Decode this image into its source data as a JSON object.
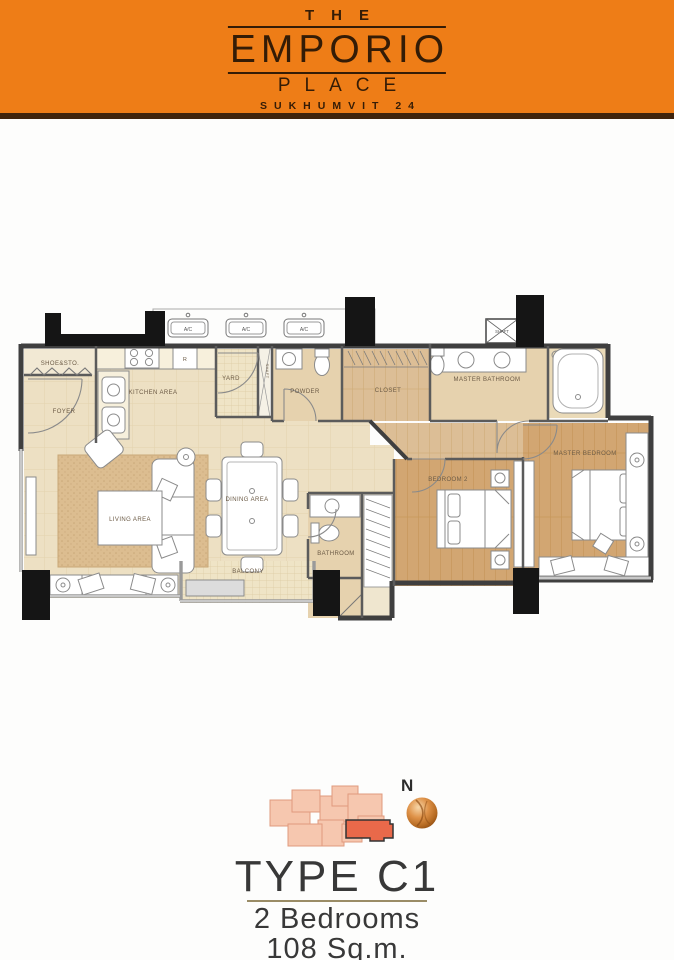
{
  "header": {
    "the": "THE",
    "emporio": "EMPORIO",
    "place": "PLACE",
    "subtitle": "SUKHUMVIT 24",
    "background_color": "#EE7D17",
    "text_color": "#341C06"
  },
  "plan": {
    "labels": {
      "shoe_sto": "SHOE&STO.",
      "foyer": "FOYER",
      "kitchen": "KITCHEN AREA",
      "yard": "YARD",
      "shaft": "SHAFT",
      "powder": "POWDER",
      "closet": "CLOSET",
      "master_bathroom": "MASTER BATHROOM",
      "living": "LIVING AREA",
      "dining": "DINING AREA",
      "balcony": "BALCONY",
      "bathroom": "BATHROOM",
      "bedroom2": "BEDROOM 2",
      "master_bedroom": "MASTER BEDROOM",
      "ac": "A/C",
      "fridge": "R"
    },
    "colors": {
      "floor_cream": "#EDE0C3",
      "floor_wood": "#D2A672",
      "floor_wood_light": "#DCBE96",
      "floor_tile": "#EFE4C6",
      "bath_tan": "#E6D2AE",
      "rug": "#DCBD90",
      "wall": "#3F3F3F",
      "column": "#151515",
      "label_text": "#6b5a45"
    }
  },
  "keyplan": {
    "north": "N",
    "building_color": "#F6C7AF",
    "highlight_color": "#E9694A"
  },
  "footer": {
    "type": "TYPE C1",
    "bedrooms": "2 Bedrooms",
    "area": "108 Sq.m."
  }
}
